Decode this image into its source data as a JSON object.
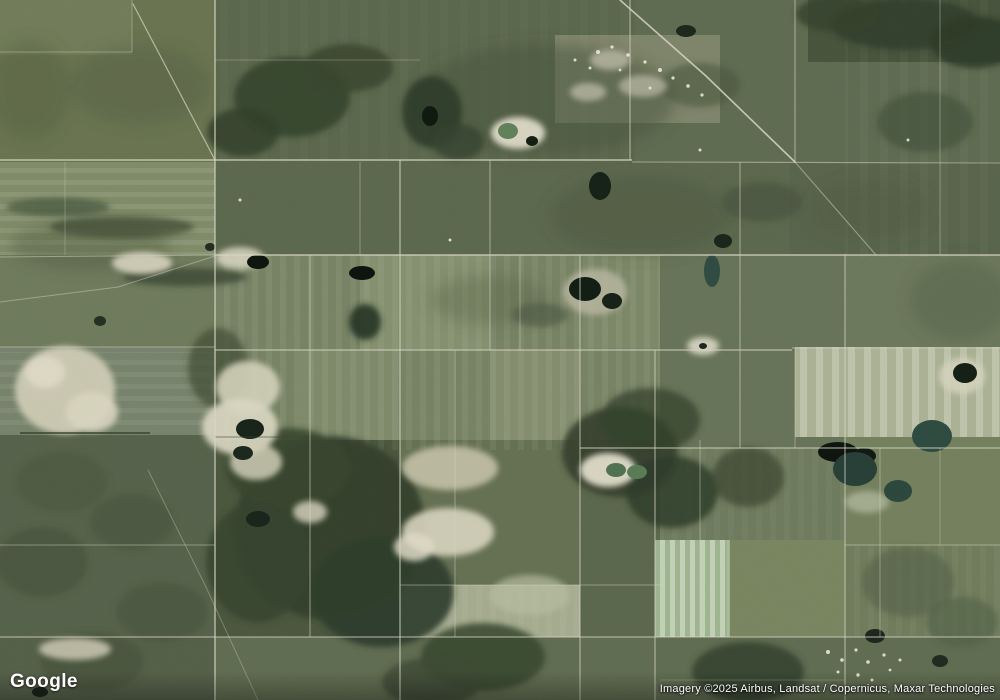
{
  "map": {
    "logo_text": "Google",
    "attribution": "Imagery ©2025 Airbus, Landsat / Copernicus, Maxar Technologies",
    "view_type": "satellite"
  },
  "palette": {
    "base": "#5c664d",
    "road": "#d8d5c4",
    "sand": "#d5d2bd",
    "forest": "#33402d",
    "pond_dark": "#141f15",
    "pond_teal": "#2e4a40",
    "speck": "#e9e7d9",
    "logo_color": "#ffffff",
    "attribution_color": "#ffffff"
  },
  "scene": {
    "regions": [
      [
        0,
        0,
        1000,
        700,
        "#5c664d",
        1
      ],
      [
        0,
        0,
        215,
        162,
        "#68724f",
        1
      ],
      [
        0,
        0,
        132,
        55,
        "#707a58",
        1
      ],
      [
        215,
        0,
        420,
        162,
        "#5a664b",
        1
      ],
      [
        635,
        0,
        365,
        162,
        "#5e6a50",
        1
      ],
      [
        808,
        0,
        192,
        62,
        "#47533c",
        1
      ],
      [
        0,
        162,
        215,
        93,
        "#7e8a67",
        1
      ],
      [
        215,
        162,
        575,
        93,
        "#5b674c",
        1
      ],
      [
        790,
        162,
        210,
        186,
        "#57634a",
        1
      ],
      [
        0,
        255,
        215,
        92,
        "#6d795b",
        1
      ],
      [
        0,
        347,
        215,
        88,
        "#75816a",
        1
      ],
      [
        215,
        255,
        445,
        195,
        "#758162",
        1
      ],
      [
        360,
        255,
        130,
        95,
        "#879372",
        0.75
      ],
      [
        490,
        350,
        90,
        100,
        "#8a9573",
        0.6
      ],
      [
        300,
        350,
        100,
        98,
        "#818d6c",
        0.6
      ],
      [
        583,
        255,
        77,
        93,
        "#7e8a69",
        0.6
      ],
      [
        660,
        255,
        185,
        193,
        "#667257",
        1
      ],
      [
        845,
        255,
        155,
        93,
        "#6b775a",
        1
      ],
      [
        795,
        347,
        205,
        90,
        "#a9b092",
        1
      ],
      [
        845,
        437,
        155,
        108,
        "#727e5c",
        1
      ],
      [
        660,
        448,
        185,
        92,
        "#6d795c",
        1
      ],
      [
        0,
        435,
        215,
        265,
        "#55614a",
        1
      ],
      [
        215,
        440,
        185,
        200,
        "#4a563d",
        1
      ],
      [
        400,
        440,
        180,
        145,
        "#646f52",
        1
      ],
      [
        400,
        585,
        185,
        52,
        "#a3aa8c",
        1
      ],
      [
        580,
        440,
        80,
        197,
        "#5a664b",
        1
      ],
      [
        215,
        637,
        785,
        63,
        "#5f6b50",
        1
      ],
      [
        655,
        540,
        75,
        97,
        "#9db38e",
        1
      ],
      [
        730,
        540,
        115,
        97,
        "#77845f",
        1
      ],
      [
        845,
        545,
        155,
        92,
        "#6e7a5a",
        1
      ],
      [
        0,
        637,
        215,
        63,
        "#545f48",
        1
      ],
      [
        555,
        35,
        165,
        88,
        "#7d8368",
        1
      ]
    ],
    "stripes": [
      [
        215,
        255,
        445,
        195,
        "p-v14",
        0.55
      ],
      [
        795,
        347,
        205,
        90,
        "p-v16",
        0.8
      ],
      [
        655,
        540,
        75,
        97,
        "p-v10",
        0.85
      ],
      [
        0,
        162,
        215,
        93,
        "p-h12",
        0.7
      ],
      [
        845,
        0,
        155,
        257,
        "p-v20",
        0.35
      ],
      [
        400,
        585,
        185,
        52,
        "p-v14",
        0.4
      ],
      [
        0,
        352,
        215,
        80,
        "p-h12",
        0.5
      ],
      [
        215,
        0,
        420,
        162,
        "p-v20",
        0.25
      ],
      [
        660,
        448,
        185,
        92,
        "p-v14",
        0.3
      ],
      [
        845,
        545,
        155,
        92,
        "p-v14",
        0.35
      ]
    ],
    "shades": [
      [
        545,
        100,
        130,
        55,
        "#46523c",
        0.5
      ],
      [
        640,
        215,
        90,
        40,
        "#4b573f",
        0.45
      ],
      [
        140,
        85,
        70,
        40,
        "#4e5a42",
        0.35
      ],
      [
        90,
        245,
        80,
        25,
        "#4d5941",
        0.4
      ],
      [
        870,
        210,
        60,
        30,
        "#4f5b43",
        0.4
      ],
      [
        490,
        300,
        60,
        25,
        "#525e46",
        0.35
      ],
      [
        960,
        300,
        50,
        40,
        "#505c44",
        0.4
      ],
      [
        30,
        90,
        40,
        50,
        "#4c5840",
        0.35
      ]
    ],
    "forests": [
      [
        292,
        97,
        58,
        40,
        "#35422e",
        0.9
      ],
      [
        348,
        68,
        45,
        24,
        "#3a472f",
        0.85
      ],
      [
        243,
        132,
        36,
        24,
        "#323f2b",
        0.85
      ],
      [
        432,
        112,
        30,
        36,
        "#2e3b29",
        0.9
      ],
      [
        458,
        142,
        26,
        18,
        "#35422e",
        0.8
      ],
      [
        905,
        24,
        75,
        26,
        "#313e2b",
        0.9
      ],
      [
        975,
        42,
        45,
        26,
        "#2d3a28",
        0.9
      ],
      [
        838,
        14,
        42,
        18,
        "#35422e",
        0.85
      ],
      [
        925,
        122,
        48,
        30,
        "#45513a",
        0.7
      ],
      [
        762,
        202,
        40,
        20,
        "#44503a",
        0.6
      ],
      [
        330,
        528,
        95,
        92,
        "#323f2d",
        0.95
      ],
      [
        288,
        468,
        62,
        40,
        "#38452f",
        0.9
      ],
      [
        382,
        592,
        72,
        55,
        "#2f3c2b",
        0.9
      ],
      [
        258,
        562,
        52,
        60,
        "#36432e",
        0.85
      ],
      [
        650,
        420,
        50,
        32,
        "#3a4631",
        0.8
      ],
      [
        620,
        452,
        58,
        45,
        "#333f2c",
        0.9
      ],
      [
        672,
        492,
        46,
        36,
        "#2f3c29",
        0.85
      ],
      [
        748,
        477,
        36,
        30,
        "#3c4833",
        0.75
      ],
      [
        483,
        657,
        62,
        34,
        "#37442f",
        0.85
      ],
      [
        432,
        682,
        50,
        24,
        "#3c4832",
        0.8
      ],
      [
        748,
        672,
        56,
        30,
        "#34412d",
        0.85
      ],
      [
        62,
        482,
        46,
        30,
        "#4b5740",
        0.7
      ],
      [
        132,
        522,
        42,
        28,
        "#49553e",
        0.7
      ],
      [
        42,
        562,
        46,
        35,
        "#46523b",
        0.7
      ],
      [
        162,
        612,
        46,
        30,
        "#4a5640",
        0.7
      ],
      [
        92,
        662,
        52,
        30,
        "#47533c",
        0.7
      ],
      [
        185,
        277,
        62,
        9,
        "#3c4833",
        0.8
      ],
      [
        122,
        227,
        72,
        11,
        "#414d37",
        0.75
      ],
      [
        58,
        207,
        52,
        9,
        "#45513a",
        0.7
      ],
      [
        908,
        582,
        46,
        35,
        "#54614a",
        0.65
      ],
      [
        962,
        622,
        36,
        25,
        "#505d46",
        0.6
      ],
      [
        540,
        315,
        28,
        12,
        "#4a5640",
        0.6
      ],
      [
        700,
        85,
        40,
        22,
        "#49553e",
        0.6
      ],
      [
        218,
        368,
        30,
        40,
        "#3f4b35",
        0.7
      ],
      [
        365,
        322,
        16,
        18,
        "#1f2f22",
        0.85
      ]
    ],
    "sands": [
      [
        65,
        390,
        50,
        44,
        "#ccc9b2",
        0.95
      ],
      [
        45,
        372,
        20,
        16,
        "#ded8c4",
        0.9
      ],
      [
        92,
        412,
        26,
        20,
        "#d8d4be",
        0.9
      ],
      [
        142,
        263,
        30,
        11,
        "#d5d2bc",
        0.9
      ],
      [
        240,
        258,
        24,
        11,
        "#d8d5c0",
        0.85
      ],
      [
        248,
        387,
        32,
        26,
        "#d2cfb8",
        0.9
      ],
      [
        240,
        427,
        38,
        28,
        "#d8d5bf",
        0.92
      ],
      [
        256,
        462,
        26,
        18,
        "#cfccb5",
        0.85
      ],
      [
        450,
        468,
        48,
        22,
        "#c2bfa4",
        0.9
      ],
      [
        448,
        532,
        46,
        24,
        "#d6d3bd",
        0.9
      ],
      [
        414,
        547,
        20,
        14,
        "#ddd9c5",
        0.85
      ],
      [
        703,
        346,
        16,
        9,
        "#d8d5c2",
        0.9
      ],
      [
        518,
        133,
        27,
        16,
        "#dcd8c6",
        0.95
      ],
      [
        962,
        376,
        23,
        18,
        "#d3d0ba",
        0.9
      ],
      [
        75,
        649,
        36,
        11,
        "#cbc8b1",
        0.85
      ],
      [
        310,
        512,
        17,
        11,
        "#d8d5c0",
        0.8
      ],
      [
        867,
        502,
        22,
        11,
        "#b7bca1",
        0.7
      ],
      [
        610,
        60,
        20,
        10,
        "#c5c2ad",
        0.7
      ],
      [
        643,
        86,
        24,
        11,
        "#bdbaa6",
        0.7
      ],
      [
        588,
        92,
        18,
        9,
        "#c9c6b1",
        0.65
      ],
      [
        530,
        595,
        40,
        20,
        "#b5ba9e",
        0.7
      ],
      [
        608,
        470,
        28,
        17,
        "#dedbc8",
        0.95
      ],
      [
        595,
        292,
        32,
        23,
        "#b9b7a0",
        0.8
      ]
    ],
    "ponds": [
      [
        600,
        186,
        11,
        14,
        "#162117"
      ],
      [
        723,
        241,
        9,
        7,
        "#1a251b"
      ],
      [
        585,
        289,
        16,
        12,
        "#121d13"
      ],
      [
        612,
        301,
        10,
        8,
        "#162117"
      ],
      [
        258,
        262,
        11,
        7,
        "#0d150e"
      ],
      [
        362,
        273,
        13,
        7,
        "#0c140d"
      ],
      [
        838,
        452,
        20,
        10,
        "#0d150e"
      ],
      [
        864,
        456,
        12,
        8,
        "#111a12"
      ],
      [
        250,
        429,
        14,
        10,
        "#18231a"
      ],
      [
        243,
        453,
        10,
        7,
        "#1c271d"
      ],
      [
        258,
        519,
        12,
        8,
        "#19241a"
      ],
      [
        965,
        373,
        12,
        10,
        "#141f15"
      ],
      [
        508,
        131,
        10,
        8,
        "#5e7f58"
      ],
      [
        616,
        470,
        10,
        7,
        "#4e7050"
      ],
      [
        637,
        472,
        10,
        7,
        "#577a55"
      ],
      [
        932,
        436,
        20,
        16,
        "#2e4a40"
      ],
      [
        712,
        271,
        8,
        16,
        "#2f4b41"
      ],
      [
        855,
        469,
        22,
        17,
        "#273f36"
      ],
      [
        898,
        491,
        14,
        11,
        "#2c463c"
      ],
      [
        430,
        116,
        8,
        10,
        "#10190f"
      ],
      [
        532,
        141,
        6,
        5,
        "#141d12"
      ],
      [
        703,
        346,
        4,
        3,
        "#1c271d"
      ],
      [
        100,
        321,
        6,
        5,
        "#242f21"
      ],
      [
        875,
        636,
        10,
        7,
        "#1b261c"
      ],
      [
        940,
        661,
        8,
        6,
        "#202b20"
      ],
      [
        686,
        31,
        10,
        6,
        "#1d281d"
      ],
      [
        210,
        247,
        5,
        4,
        "#222d20"
      ],
      [
        40,
        692,
        8,
        5,
        "#18231a"
      ]
    ],
    "dark_lines": [
      [
        20,
        433,
        150,
        433,
        0.7,
        2,
        "#333f2a"
      ],
      [
        215,
        437,
        310,
        437,
        0.4,
        1.5,
        "#3a4630"
      ]
    ],
    "roads": [
      [
        0,
        160,
        632,
        160,
        0.8,
        1.4
      ],
      [
        632,
        162,
        1000,
        163,
        0.55,
        1.1
      ],
      [
        215,
        255,
        1000,
        255,
        0.8,
        1.4
      ],
      [
        0,
        257,
        215,
        255,
        0.5,
        1.1
      ],
      [
        0,
        347,
        215,
        347,
        0.5,
        1
      ],
      [
        215,
        350,
        792,
        350,
        0.75,
        1.3
      ],
      [
        792,
        348,
        1000,
        348,
        0.65,
        1.1
      ],
      [
        580,
        448,
        1000,
        448,
        0.7,
        1.2
      ],
      [
        0,
        545,
        215,
        545,
        0.45,
        1
      ],
      [
        845,
        545,
        1000,
        545,
        0.5,
        1
      ],
      [
        400,
        585,
        660,
        585,
        0.45,
        1
      ],
      [
        0,
        637,
        1000,
        637,
        0.65,
        1.2
      ],
      [
        215,
        60,
        420,
        60,
        0.3,
        1
      ],
      [
        0,
        52,
        132,
        52,
        0.4,
        1
      ],
      [
        660,
        680,
        845,
        680,
        0.25,
        1
      ],
      [
        215,
        0,
        215,
        700,
        0.8,
        1.4
      ],
      [
        310,
        255,
        310,
        637,
        0.55,
        1.1
      ],
      [
        360,
        162,
        360,
        255,
        0.4,
        1
      ],
      [
        400,
        160,
        400,
        700,
        0.7,
        1.3
      ],
      [
        490,
        160,
        490,
        350,
        0.55,
        1.1
      ],
      [
        455,
        350,
        455,
        637,
        0.45,
        1
      ],
      [
        520,
        255,
        520,
        350,
        0.4,
        1
      ],
      [
        580,
        255,
        580,
        700,
        0.65,
        1.2
      ],
      [
        630,
        0,
        630,
        160,
        0.65,
        1.2
      ],
      [
        655,
        350,
        655,
        700,
        0.65,
        1.2
      ],
      [
        700,
        440,
        700,
        637,
        0.45,
        1
      ],
      [
        740,
        162,
        740,
        448,
        0.55,
        1.1
      ],
      [
        795,
        0,
        795,
        162,
        0.6,
        1.1
      ],
      [
        795,
        348,
        795,
        448,
        0.45,
        1
      ],
      [
        845,
        255,
        845,
        700,
        0.65,
        1.2
      ],
      [
        880,
        448,
        880,
        637,
        0.45,
        1
      ],
      [
        940,
        0,
        940,
        255,
        0.4,
        1
      ],
      [
        940,
        448,
        940,
        545,
        0.35,
        1
      ],
      [
        132,
        0,
        132,
        52,
        0.4,
        1
      ],
      [
        65,
        162,
        65,
        255,
        0.3,
        1
      ],
      [
        728,
        540,
        728,
        637,
        0.4,
        1
      ]
    ],
    "diagonals": [
      {
        "points": [
          [
            133,
            4
          ],
          [
            215,
            160
          ]
        ],
        "opacity": 0.7,
        "width": 1.2
      },
      {
        "points": [
          [
            620,
            0
          ],
          [
            706,
            76
          ],
          [
            795,
            162
          ]
        ],
        "opacity": 0.85,
        "width": 1.6
      },
      {
        "points": [
          [
            795,
            162
          ],
          [
            876,
            255
          ]
        ],
        "opacity": 0.5,
        "width": 1.1
      },
      {
        "points": [
          [
            0,
            302
          ],
          [
            118,
            287
          ],
          [
            215,
            256
          ]
        ],
        "opacity": 0.45,
        "width": 1
      },
      {
        "points": [
          [
            148,
            470
          ],
          [
            205,
            585
          ],
          [
            258,
            700
          ]
        ],
        "opacity": 0.35,
        "width": 1
      }
    ],
    "specks": [
      [
        598,
        52,
        2
      ],
      [
        612,
        47,
        1.6
      ],
      [
        628,
        55,
        1.8
      ],
      [
        645,
        62,
        1.6
      ],
      [
        660,
        70,
        2
      ],
      [
        673,
        78,
        1.6
      ],
      [
        688,
        86,
        1.8
      ],
      [
        702,
        95,
        1.6
      ],
      [
        590,
        68,
        1.5
      ],
      [
        575,
        60,
        1.5
      ],
      [
        620,
        70,
        1.4
      ],
      [
        650,
        88,
        1.5
      ],
      [
        828,
        652,
        2
      ],
      [
        842,
        660,
        1.8
      ],
      [
        856,
        650,
        1.6
      ],
      [
        868,
        662,
        1.8
      ],
      [
        884,
        655,
        1.6
      ],
      [
        838,
        672,
        1.5
      ],
      [
        858,
        675,
        1.7
      ],
      [
        872,
        680,
        1.5
      ],
      [
        890,
        670,
        1.4
      ],
      [
        900,
        660,
        1.5
      ],
      [
        450,
        240,
        1.5
      ],
      [
        700,
        150,
        1.5
      ],
      [
        908,
        140,
        1.5
      ],
      [
        240,
        200,
        1.5
      ]
    ]
  }
}
